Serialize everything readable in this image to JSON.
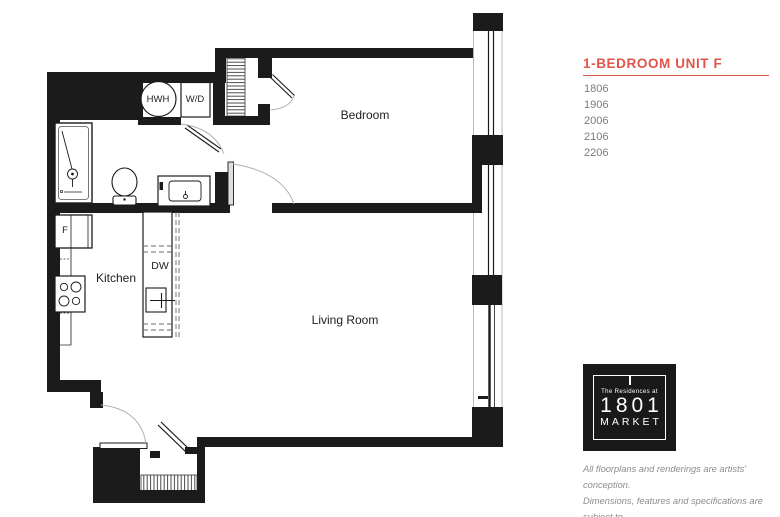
{
  "colors": {
    "accent": "#e0544b",
    "wall": "#1b1b1b",
    "unit_text": "#7b7b7b",
    "disclaimer_text": "#8c8c8c",
    "logo_bg": "#191919"
  },
  "panel": {
    "title": "1-BEDROOM UNIT F",
    "units": [
      "1806",
      "1906",
      "2006",
      "2106",
      "2206"
    ],
    "logo": {
      "tagline": "The Residences at",
      "number": "1801",
      "name": "MARKET"
    },
    "disclaimer": [
      "All floorplans and renderings are artists' conception.",
      "Dimensions, features and specifications are subject to",
      "change at the discretion of the builder."
    ]
  },
  "floorplan": {
    "rooms": {
      "bedroom": "Bedroom",
      "living_room": "Living Room",
      "kitchen": "Kitchen"
    },
    "appliances": {
      "hot_water_heater": "HWH",
      "washer_dryer": "W/D",
      "dishwasher": "DW",
      "refrigerator": "F"
    }
  }
}
